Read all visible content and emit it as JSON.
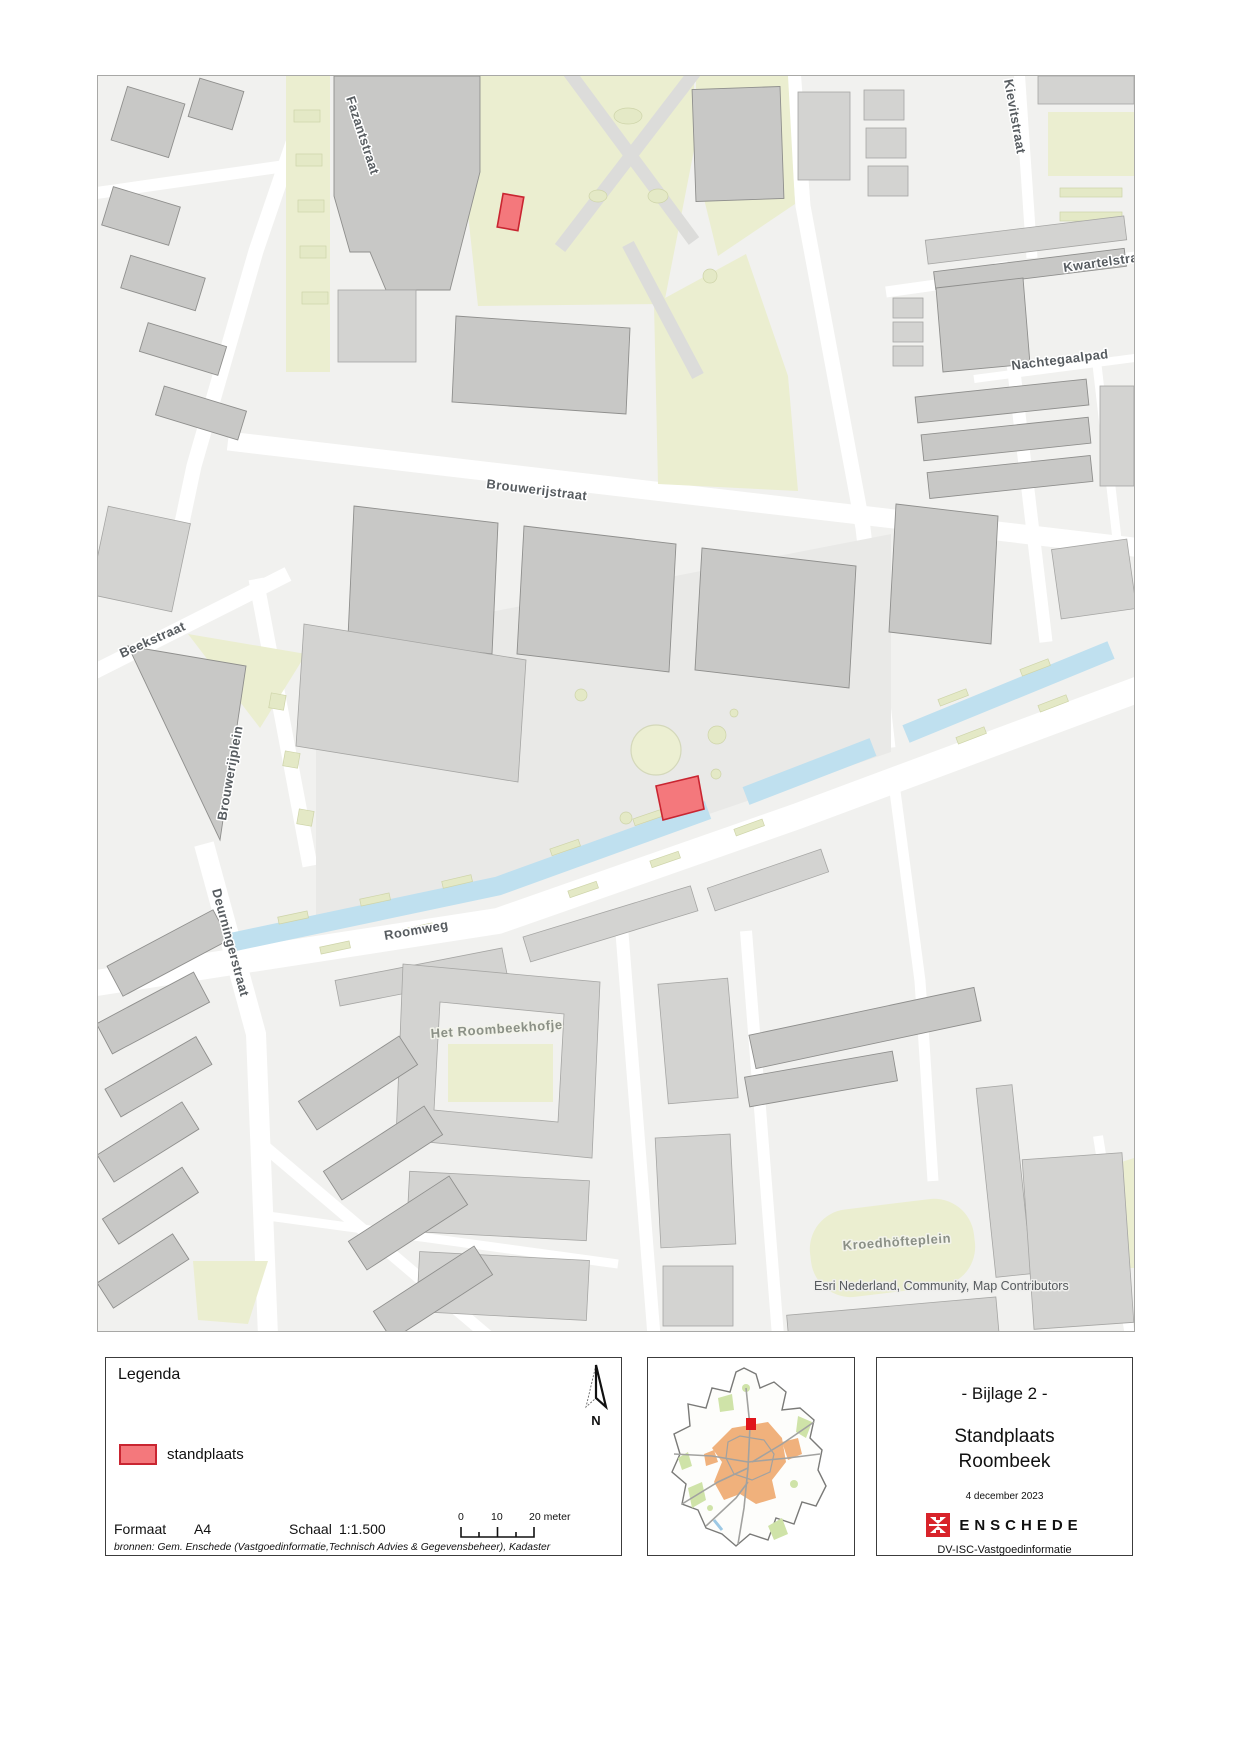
{
  "map": {
    "streets": {
      "fazantstraat": "Fazantstraat",
      "kievitstraat": "Kievitstraat",
      "kwartelstraat": "Kwartelstraat",
      "nachtegaalpad": "Nachtegaalpad",
      "brouwerijstraat": "Brouwerijstraat",
      "beekstraat": "Beekstraat",
      "brouwerijplein": "Brouwerijplein",
      "roomweg": "Roomweg",
      "deurningerstraat": "Deurningerstraat"
    },
    "places": {
      "roombeekhofje": "Het Roombeekhofje",
      "kroedhofteplein": "Kroedhöfteplein"
    },
    "attribution": "Esri Nederland, Community, Map Contributors",
    "marker_fill": "#f4787c",
    "marker_stroke": "#c92531",
    "water_color": "#bfe0ef",
    "green_color": "#ebeed0"
  },
  "legend": {
    "title": "Legenda",
    "item_label": "standplaats",
    "north_label": "N",
    "format_label": "Formaat",
    "format_value": "A4",
    "scale_label": "Schaal",
    "scale_value": "1:1.500",
    "scalebar_ticks": [
      "0",
      "10",
      "20 meter"
    ],
    "sources": "bronnen: Gem. Enschede (Vastgoedinformatie,Technisch Advies & Gegevensbeheer), Kadaster"
  },
  "title_block": {
    "appendix": "- Bijlage 2 -",
    "title_line1": "Standplaats",
    "title_line2": "Roombeek",
    "date": "4 december 2023",
    "org_name": "ENSCHEDE",
    "department": "DV-ISC-Vastgoedinformatie"
  }
}
